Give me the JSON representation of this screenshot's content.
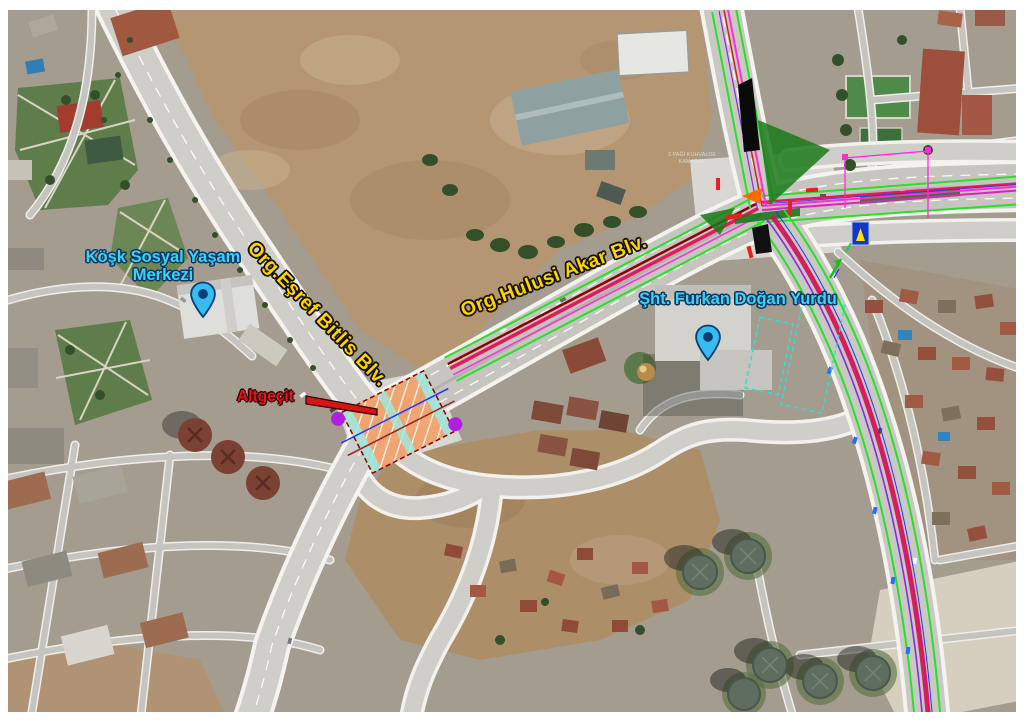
{
  "map": {
    "labels": {
      "kosk_merkezi": "Köşk Sosyal Yaşam Merkezi",
      "esref_bitlis": "Org.Eşref Bitlis Blv.",
      "hulusi_akar": "Org.Hulusi Akar Blv.",
      "furkan_yurdu": "Şht. Furkan Doğan Yurdu",
      "altgecit": "Altgeçit",
      "tiny_note": "2.PAĞI KUHVALDE KAMARAK"
    },
    "colors": {
      "label_cyan": "#3fd2f7",
      "label_yellow": "#ffd400",
      "label_red": "#ee1414",
      "pin_fill": "#35bdf0",
      "overlay_green": "#28e028",
      "overlay_magenta": "#ff2bd6",
      "overlay_crimson": "#e8175d",
      "overlay_purple": "#8a2be2",
      "underpass_orange": "#f2a269",
      "underpass_cyan": "#9fe8e0"
    }
  }
}
